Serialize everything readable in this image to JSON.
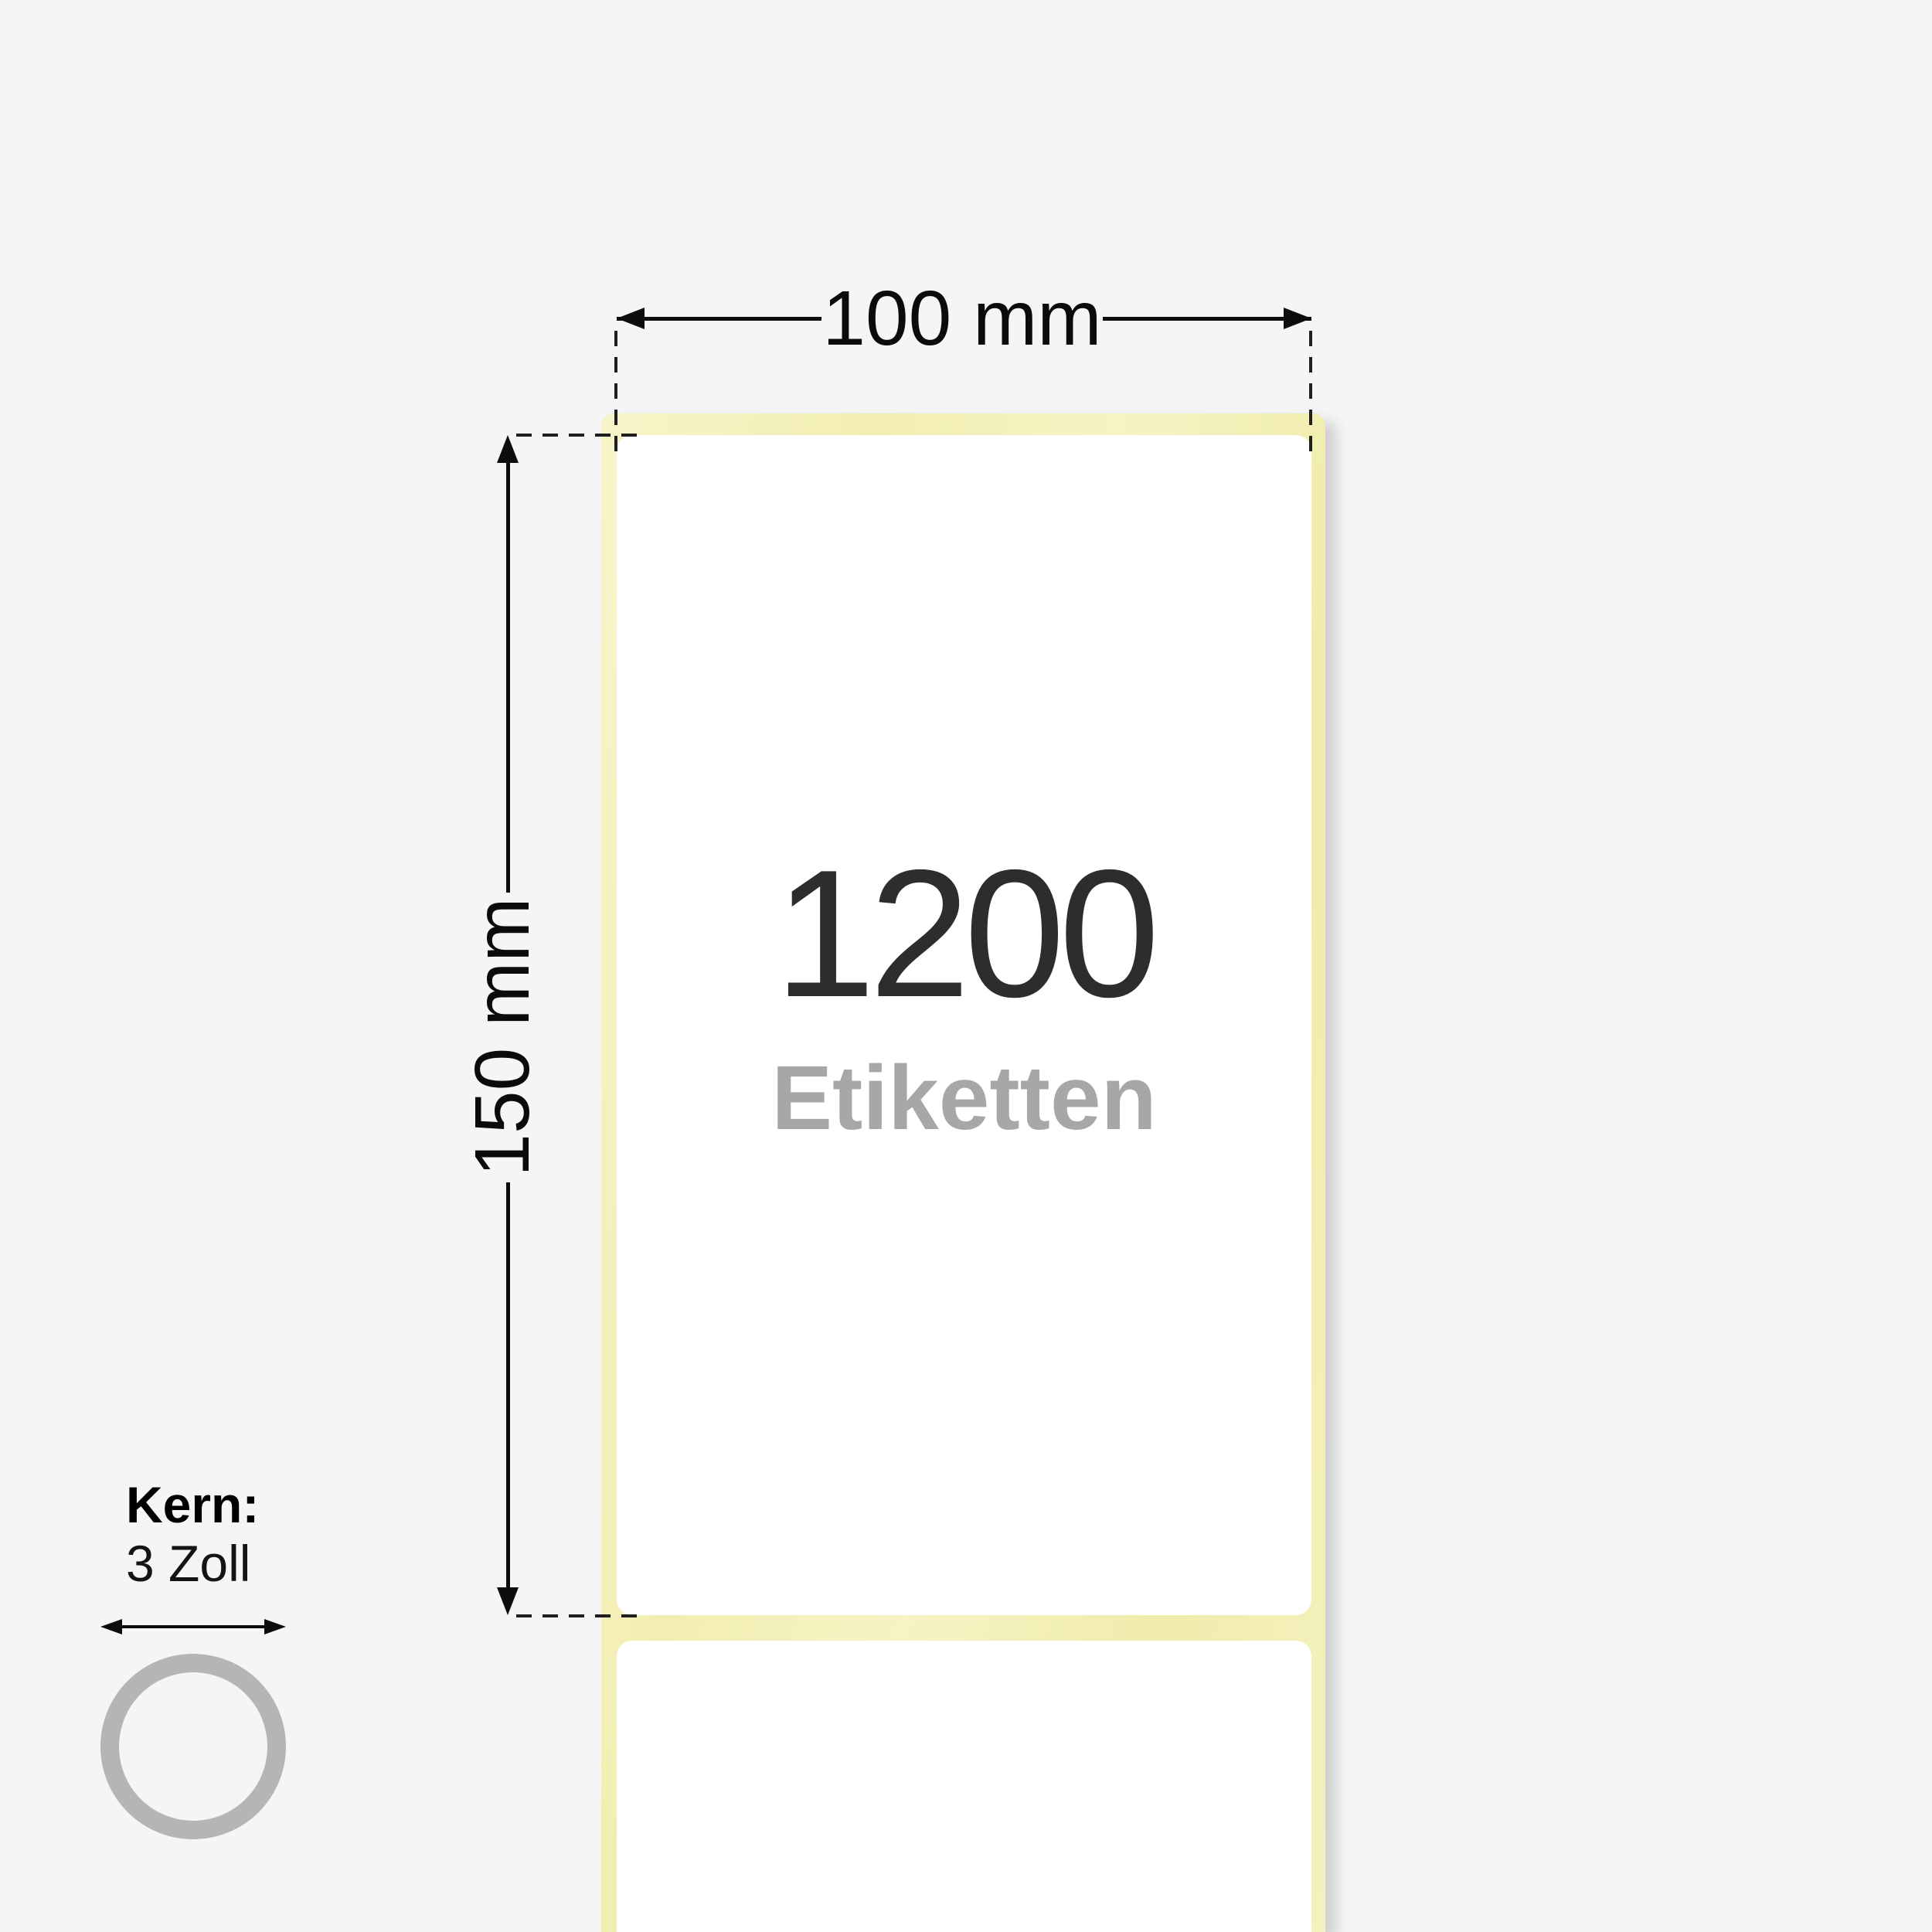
{
  "diagram": {
    "dimensions": {
      "width_label": "100 mm",
      "height_label": "150 mm"
    },
    "roll": {
      "count": "1200",
      "count_unit": "Etiketten"
    },
    "core": {
      "title": "Kern:",
      "size": "3 Zoll"
    },
    "colors": {
      "background": "#f5f5f5",
      "liner_yellow": "#f5f1bd",
      "label_white": "#ffffff",
      "count_text": "#2d2d2d",
      "unit_text": "#a7a7a7",
      "dimension_line": "#0d0d0d",
      "core_ring_gray": "#b5b5b5"
    }
  }
}
